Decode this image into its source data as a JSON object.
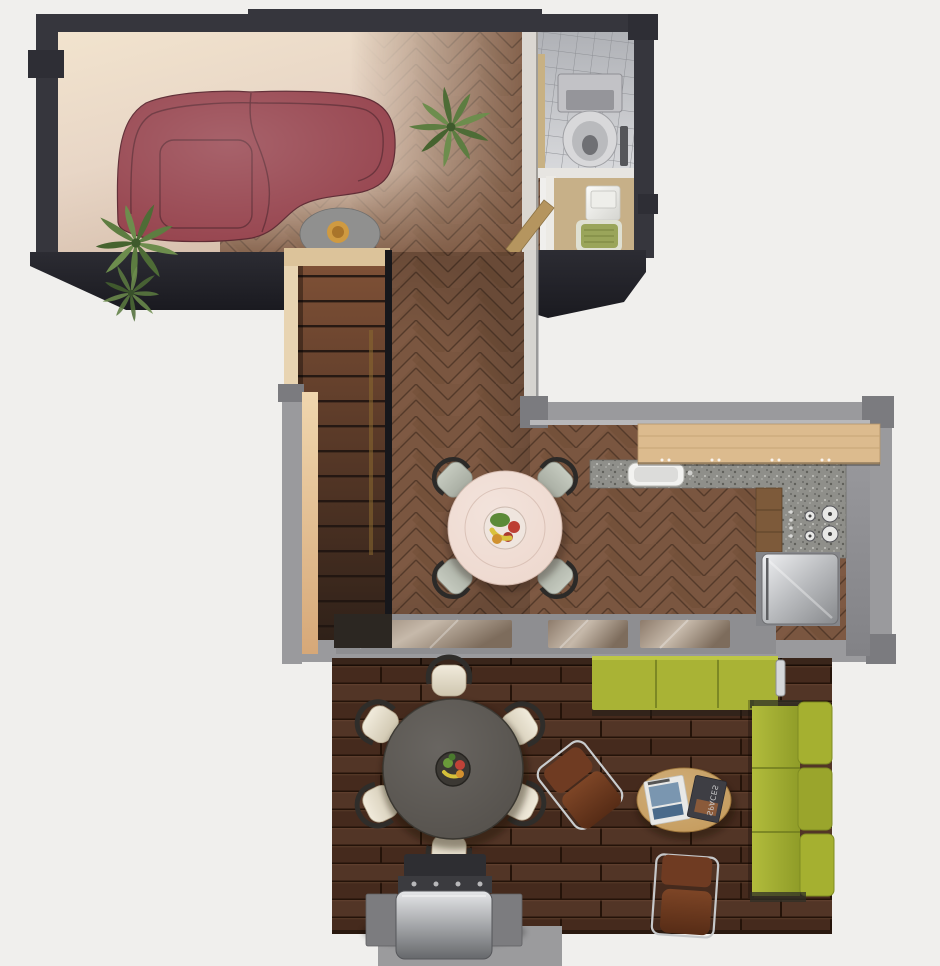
{
  "scene": {
    "type": "3d-apartment-floor-plan-top-view",
    "background": "#f0efed"
  },
  "palette": {
    "wall_dark": "#36363d",
    "wall_gray": "#9a9a9d",
    "wall_face_tan": "#e8d4b2",
    "overhang_dark": "#26262c",
    "floor_cream": "#f2e4ce",
    "floor_wood": "#7a5640",
    "deck_wood": "#4c3022",
    "tile_gray": "#c3c5c9",
    "sofa_burgundy": "#97454f",
    "sofa_green": "#a9b335",
    "chair_cream": "#e6dfcc",
    "chair_sage": "#b7bcb0",
    "chair_leather": "#6f3b22",
    "table_pink": "#eed9cf",
    "table_deck_gray": "#56524d",
    "table_coffee_wood": "#c69d5f",
    "counter_wood": "#dcbb8e",
    "granite": "#8e8e89",
    "fridge_steel": "#c6c8cb",
    "plant_green": "#64844a",
    "bowl_orange": "#cf9a41",
    "utility_floor_tan": "#c7b088",
    "pad_green": "#9aa55a",
    "stairs_wood": "#6f452f",
    "glass_reflection": "#b0a294"
  },
  "magazines": {
    "dark_magazine_title": "SPACES"
  },
  "objects": [
    {
      "name": "curved-sectional-sofa",
      "area": "living-room",
      "color": "burgundy"
    },
    {
      "name": "side-table-with-orange-bowl",
      "area": "living-room"
    },
    {
      "name": "potted-palm-plant",
      "area": "living-room",
      "count": 3
    },
    {
      "name": "toilet",
      "area": "bathroom"
    },
    {
      "name": "washing-machine",
      "area": "utility-room"
    },
    {
      "name": "green-mat",
      "area": "utility-room"
    },
    {
      "name": "staircase-with-railing",
      "area": "hallway"
    },
    {
      "name": "round-dining-table-with-fruit-bowl",
      "area": "dining-area",
      "seats": 4
    },
    {
      "name": "breakfast-bar",
      "area": "kitchen"
    },
    {
      "name": "granite-counter-with-sink",
      "area": "kitchen"
    },
    {
      "name": "cooktop-four-burners",
      "area": "kitchen"
    },
    {
      "name": "refrigerator",
      "area": "kitchen"
    },
    {
      "name": "sliding-glass-doors",
      "area": "kitchen"
    },
    {
      "name": "round-patio-table-with-lazy-susan",
      "area": "deck",
      "seats": 6
    },
    {
      "name": "patio-chair-cream",
      "area": "deck",
      "count": 6
    },
    {
      "name": "leather-sling-chair",
      "area": "deck",
      "count": 2
    },
    {
      "name": "outdoor-sofa-green",
      "area": "deck",
      "count": 2
    },
    {
      "name": "oval-coffee-table-with-magazines",
      "area": "deck"
    },
    {
      "name": "barbecue-grill",
      "area": "deck"
    }
  ]
}
